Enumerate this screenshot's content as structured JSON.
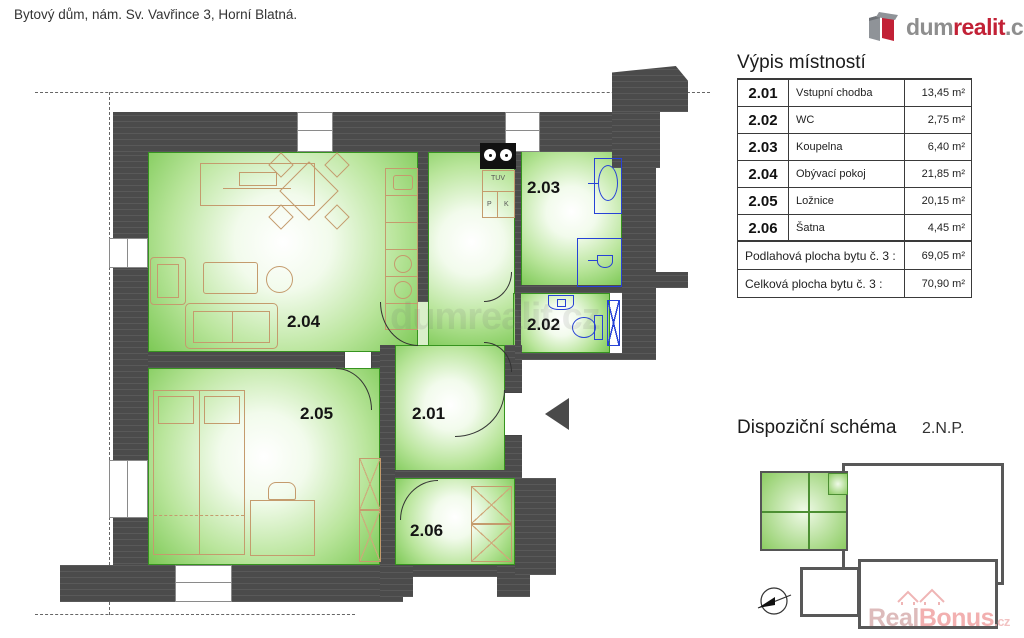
{
  "header": {
    "title": "Bytový dům, nám. Sv. Vavřince 3, Horní Blatná."
  },
  "logo": {
    "part1": "dum",
    "part2": "realit",
    "part3": ".cz"
  },
  "plan": {
    "rooms": [
      {
        "id": "2.01"
      },
      {
        "id": "2.02"
      },
      {
        "id": "2.03"
      },
      {
        "id": "2.04"
      },
      {
        "id": "2.05"
      },
      {
        "id": "2.06"
      }
    ],
    "kitchen": {
      "tuv": "TUV",
      "p": "P",
      "k": "K"
    },
    "watermark": "dumrealit.cz"
  },
  "room_table": {
    "heading": "Výpis místností",
    "rows": [
      {
        "id": "2.01",
        "name": "Vstupní chodba",
        "area": "13,45 m²"
      },
      {
        "id": "2.02",
        "name": "WC",
        "area": "2,75 m²"
      },
      {
        "id": "2.03",
        "name": "Koupelna",
        "area": "6,40 m²"
      },
      {
        "id": "2.04",
        "name": "Obývací pokoj",
        "area": "21,85 m²"
      },
      {
        "id": "2.05",
        "name": "Ložnice",
        "area": "20,15 m²"
      },
      {
        "id": "2.06",
        "name": "Šatna",
        "area": "4,45 m²"
      }
    ],
    "summary": [
      {
        "label": "Podlahová plocha bytu  č. 3 :",
        "area": "69,05 m²"
      },
      {
        "label": "Celková plocha bytu  č. 3 :",
        "area": "70,90 m²"
      }
    ]
  },
  "schema": {
    "heading": "Dispoziční schéma",
    "floor": "2.N.P."
  },
  "watermark_bonus": {
    "part1": "Real",
    "part2": "Bonus",
    "part3": ".cz"
  },
  "colors": {
    "wall": "#4b4b4b",
    "room_green": "#7dc956",
    "furniture_tan": "#c49b6d",
    "fixture_blue": "#2742d6",
    "brand_red": "#c22136"
  }
}
